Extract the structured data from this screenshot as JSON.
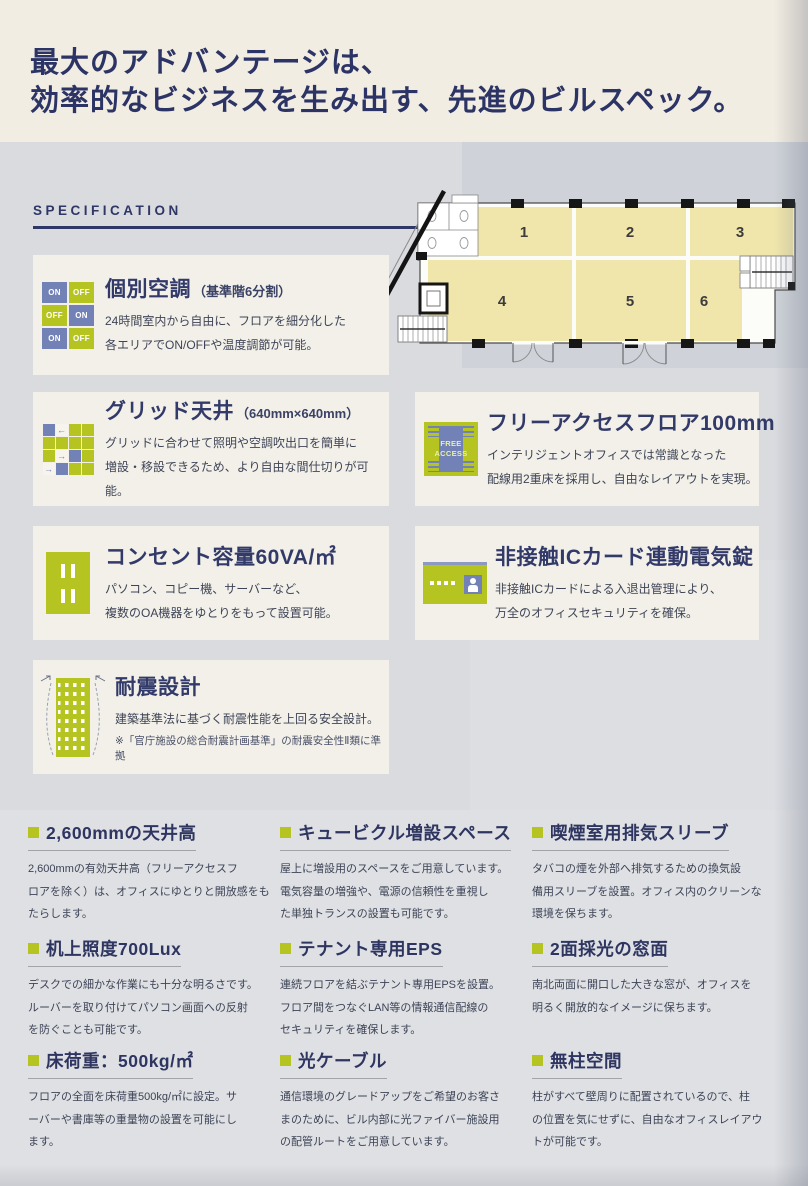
{
  "page": {
    "title": {
      "line1": "最大のアドバンテージは、",
      "line2": "効率的なビジネスを生み出す、先進のビルスペック。"
    },
    "section_heading": "SPECIFICATION"
  },
  "colors": {
    "navy_text": "#2c3465",
    "accent_green": "#b5c420",
    "accent_blue": "#7282b6",
    "panel_cream": "#f2f0e8",
    "floor_zone_yellow": "#f0e6ac",
    "page_background": "#d9dbdf"
  },
  "floor_plan": {
    "zones": [
      "1",
      "2",
      "3",
      "4",
      "5",
      "6"
    ]
  },
  "features": [
    {
      "icon": "on-off-switch-grid-icon",
      "icon_cells": [
        "ON",
        "OFF",
        "OFF",
        "ON",
        "ON",
        "OFF"
      ],
      "title": "個別空調",
      "note": "（基準階6分割）",
      "body": "24時間室内から自由に、フロアを細分化した\n各エリアでON/OFFや温度調節が可能。"
    },
    {
      "icon": "grid-ceiling-icon",
      "title": "グリッド天井",
      "note": "（640mm×640mm）",
      "body": "グリッドに合わせて照明や空調吹出口を簡単に\n増設・移設できるため、より自由な間仕切りが可能。"
    },
    {
      "icon": "free-access-floor-icon",
      "icon_text": "FREE\nACCESS",
      "title": "フリーアクセスフロア100mm",
      "body": "インテリジェントオフィスでは常識となった\n配線用2重床を採用し、自由なレイアウトを実現。"
    },
    {
      "icon": "power-outlet-icon",
      "title": "コンセント容量60VA/㎡",
      "body": "パソコン、コピー機、サーバーなど、\n複数のOA機器をゆとりをもって設置可能。"
    },
    {
      "icon": "ic-card-icon",
      "title": "非接触ICカード連動電気錠",
      "body": "非接触ICカードによる入退出管理により、\n万全のオフィスセキュリティを確保。"
    },
    {
      "icon": "seismic-building-icon",
      "title": "耐震設計",
      "body": "建築基準法に基づく耐震性能を上回る安全設計。",
      "footnote": "※「官庁施設の総合耐震計画基準」の耐震安全性Ⅱ類に準拠"
    }
  ],
  "spec_items": [
    {
      "title": "2,600mmの天井高",
      "body": "2,600mmの有効天井高（フリーアクセスフ\nロアを除く）は、オフィスにゆとりと開放感をも\nたらします。"
    },
    {
      "title": "キュービクル増設スペース",
      "body": "屋上に増設用のスペースをご用意しています。\n電気容量の増強や、電源の信頼性を重視し\nた単独トランスの設置も可能です。"
    },
    {
      "title": "喫煙室用排気スリーブ",
      "body": "タバコの煙を外部へ排気するための換気設\n備用スリーブを設置。オフィス内のクリーンな\n環境を保ちます。"
    },
    {
      "title": "机上照度700Lux",
      "body": "デスクでの細かな作業にも十分な明るさです。\nルーバーを取り付けてパソコン画面への反射\nを防ぐことも可能です。"
    },
    {
      "title": "テナント専用EPS",
      "body": "連続フロアを結ぶテナント専用EPSを設置。\nフロア間をつなぐLAN等の情報通信配線の\nセキュリティを確保します。"
    },
    {
      "title": "2面採光の窓面",
      "body": "南北両面に開口した大きな窓が、オフィスを\n明るく開放的なイメージに保ちます。"
    },
    {
      "title": "床荷重：500kg/㎡",
      "body": "フロアの全面を床荷重500kg/㎡に設定。サ\nーバーや書庫等の重量物の設置を可能にし\nます。"
    },
    {
      "title": "光ケーブル",
      "body": "通信環境のグレードアップをご希望のお客さ\nまのために、ビル内部に光ファイバー施設用\nの配管ルートをご用意しています。"
    },
    {
      "title": "無柱空間",
      "body": "柱がすべて壁周りに配置されているので、柱\nの位置を気にせずに、自由なオフィスレイアウ\nトが可能です。"
    }
  ]
}
